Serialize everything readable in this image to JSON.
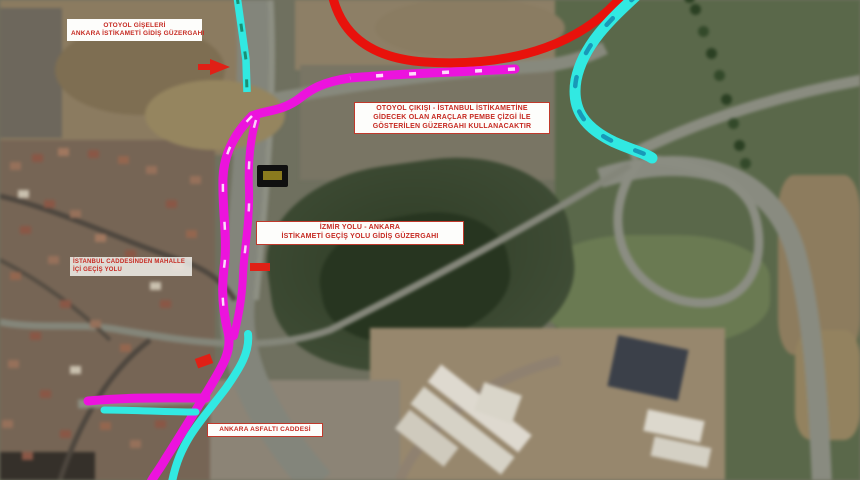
{
  "map": {
    "type": "satellite-detour-map",
    "labels": {
      "top_left": {
        "line1": "OTOYOL GİŞELERİ",
        "line2": "ANKARA İSTİKAMETİ GİDİŞ GÜZERGAHI"
      },
      "detour_note": {
        "line1": "OTOYOL ÇIKIŞI - İSTANBUL İSTİKAMETİNE",
        "line2": "GİDECEK OLAN ARAÇLAR PEMBE ÇİZGİ İLE",
        "line3": "GÖSTERİLEN GÜZERGAHI KULLANACAKTIR"
      },
      "center_route": {
        "line1": "İZMİR YOLU - ANKARA",
        "line2": "İSTİKAMETİ GEÇİŞ YOLU GİDİŞ GÜZERGAHI"
      },
      "neighborhood": {
        "line1": "İSTANBUL CADDESİNDEN MAHALLE",
        "line2": "İÇİ GEÇİŞ YOLU"
      },
      "street": {
        "line1": "ANKARA ASFALTI CADDESİ"
      }
    },
    "route_colors": {
      "highway_route_cyan": "#31e9e2",
      "detour_route_magenta": "#ec13dd",
      "closed_ramp_red": "#e8120c"
    },
    "markers": {
      "road_sign": "black-yellow-km-sign",
      "closure_arrows": 3
    }
  }
}
